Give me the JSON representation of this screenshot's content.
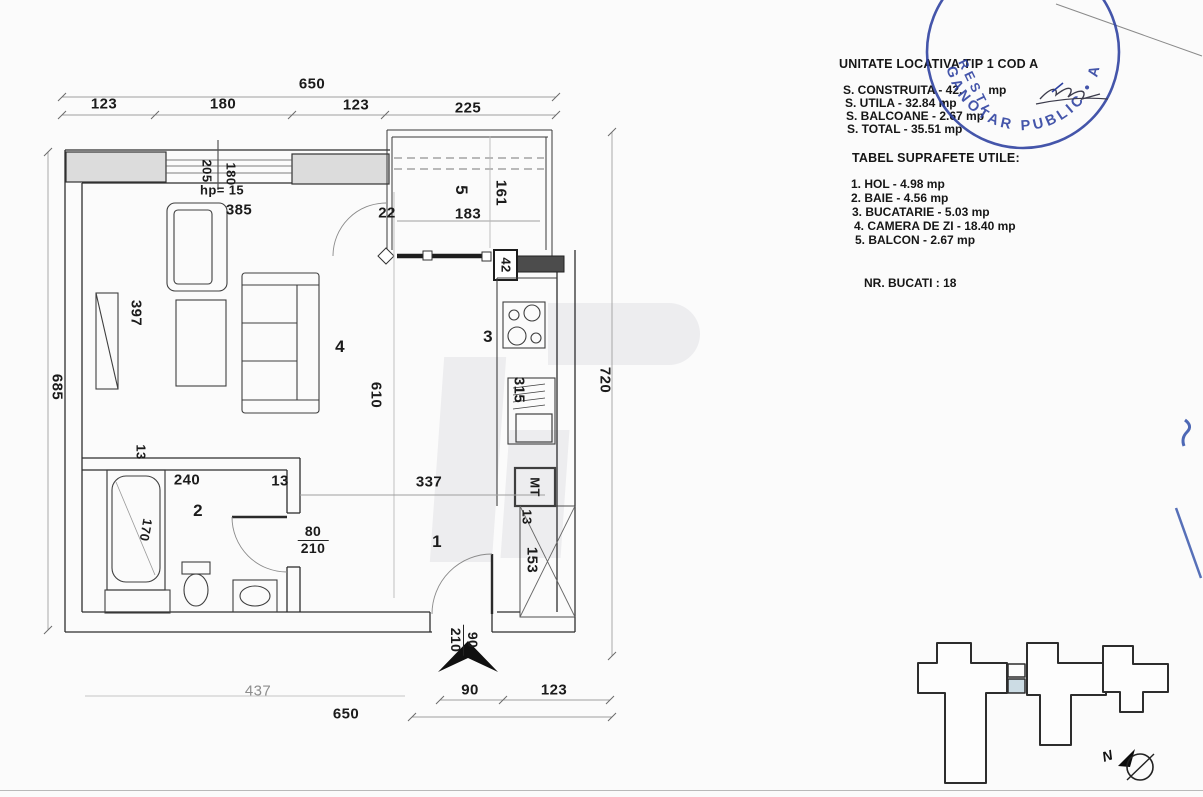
{
  "info_panel": {
    "title": "UNITATE LOCATIVA TIP 1 COD A",
    "areas": [
      "S. CONSTRUITA - 42.",
      "S. UTILA - 32.84 mp",
      "S. BALCOANE - 2.67 mp",
      "S. TOTAL - 35.51 mp"
    ],
    "construita_unit": "mp",
    "table_title": "TABEL SUPRAFETE UTILE:",
    "rooms": [
      "1. HOL - 4.98 mp",
      "2. BAIE - 4.56 mp",
      "3. BUCATARIE - 5.03 mp",
      "4. CAMERA DE ZI - 18.40 mp",
      "5. BALCON - 2.67 mp"
    ],
    "units_count": "NR. BUCATI : 18"
  },
  "stamp": {
    "ring_text": "GANOTAR PUBLIC • A",
    "side_text": "RESTI",
    "color": "#2b3f9f"
  },
  "compass": {
    "north": "N"
  },
  "site_plan": {
    "highlight_color": "#ccdce4"
  },
  "plan": {
    "room_labels": {
      "hall": "1",
      "bathroom": "2",
      "kitchen": "3",
      "living": "4",
      "balcony": "5"
    },
    "fixtures": {
      "meter": "MT",
      "parapet_height": "hp= 15"
    },
    "dims": {
      "overall_top": "650",
      "top_segments": [
        "123",
        "180",
        "123",
        "225"
      ],
      "overall_left": "685",
      "overall_right": "720",
      "interior_height": "610",
      "window_a": "205",
      "window_b": "180",
      "living_width": "385",
      "balcony_gap": "22",
      "balcony_width": "183",
      "balcony_depth": "161",
      "balcony_wall": "42",
      "radiator": "397",
      "kitchen_counter": "315",
      "hall_width": "337",
      "bath_wall_a": "13",
      "bath_width": "240",
      "bath_wall_b": "13",
      "tub_length": "170",
      "bath_door": {
        "w": "80",
        "h": "210"
      },
      "shaft_a": "13",
      "shaft_b": "153",
      "entry_door": {
        "w": "90",
        "h": "210"
      },
      "bottom_a": "437",
      "bottom_b": "90",
      "bottom_c": "123",
      "overall_bottom": "650"
    }
  }
}
